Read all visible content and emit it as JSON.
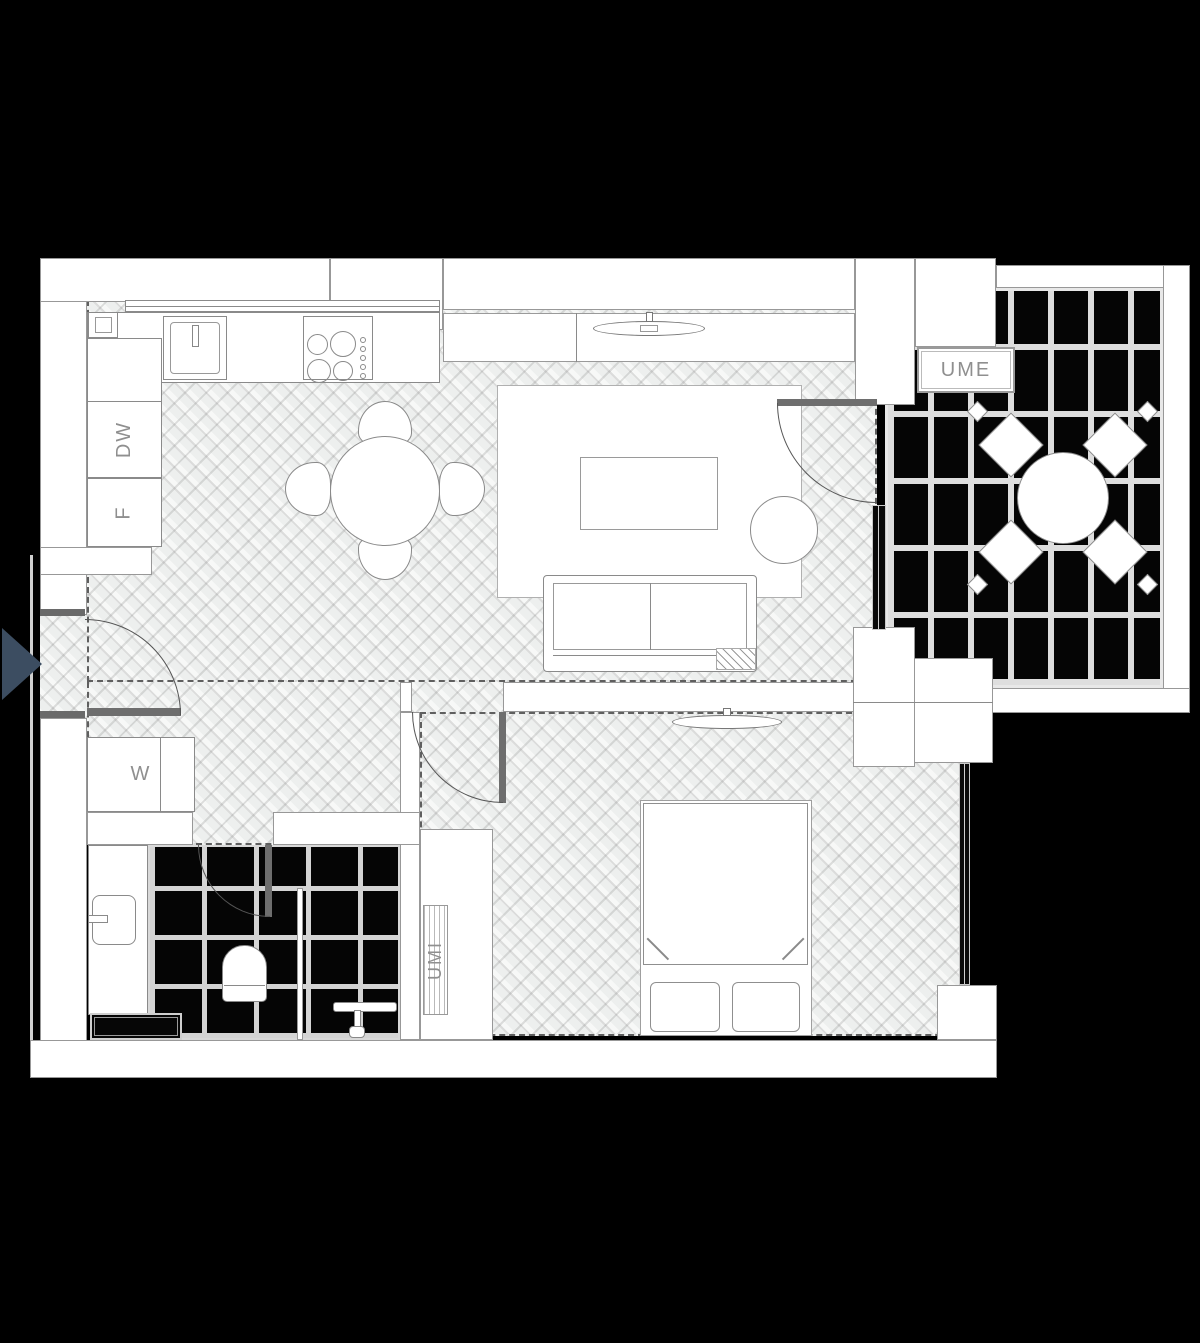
{
  "labels": {
    "dishwasher": "DW",
    "fridge": "F",
    "washer": "W",
    "balcony_unit": "UME",
    "wardrobe_unit": "UMI"
  },
  "colors": {
    "background": "#000000",
    "walls": "#ffffff",
    "wall_outline": "#989898",
    "floor_parquet": "#edefee",
    "tile_grout": "#dedede",
    "label_text": "#8f8f8f",
    "entry_arrow": "#3c4d61",
    "window_fill": "#090909"
  }
}
